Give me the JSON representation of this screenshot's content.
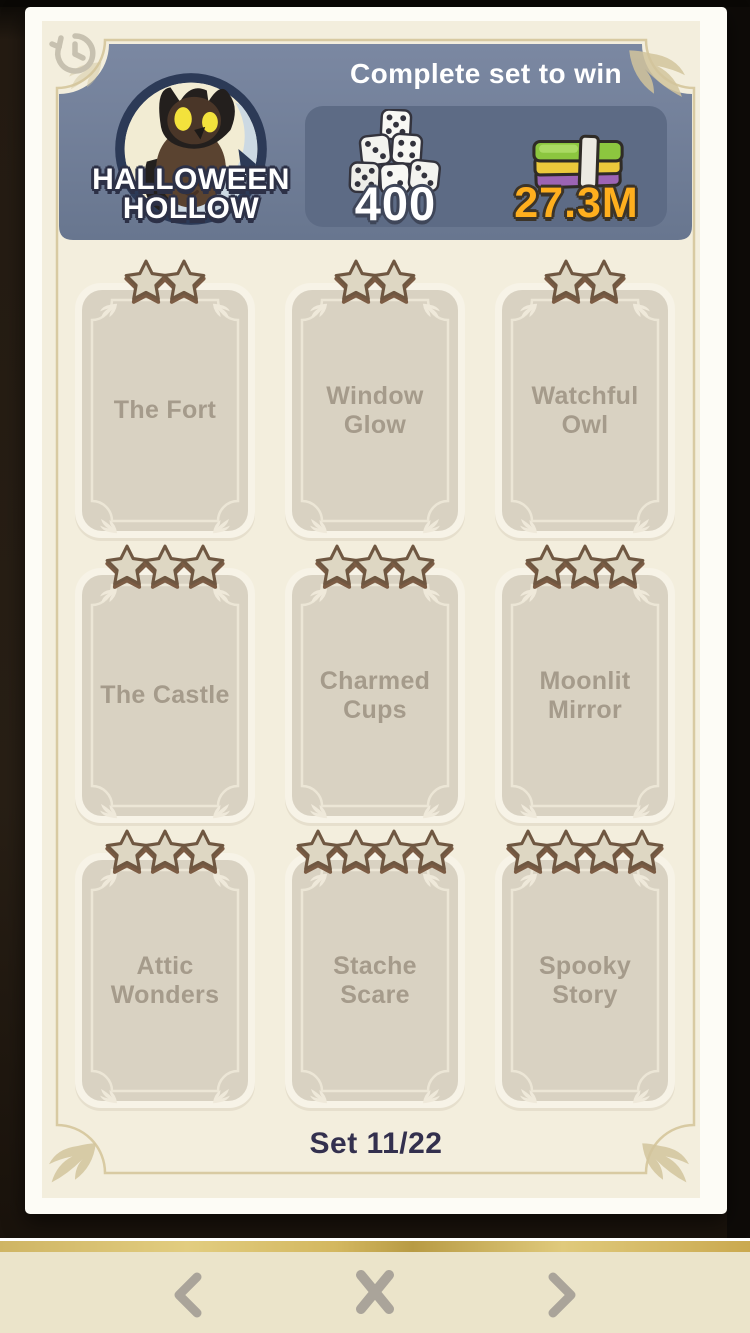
{
  "colors": {
    "page_background": "#f3eedd",
    "banner_background": "#6f7d98",
    "rewards_panel_background": "#5d6b85",
    "card_background": "#d9d2c2",
    "dice_value_color": "#ffffff",
    "cash_value_color": "#ffaf1e",
    "frame_line": "#d8caa2",
    "navbar_background": "#ebe4ca",
    "set_label_color": "#33304e"
  },
  "page": {
    "back_icon": "history-icon",
    "banner": {
      "logo_line1": "HALLOWEEN",
      "logo_line2": "HOLLOW",
      "logo_icon": "owl-moon-badge",
      "subtitle": "Complete set to win",
      "rewards": {
        "dice": {
          "icon": "dice-stack-icon",
          "value": "400"
        },
        "cash": {
          "icon": "cash-stack-icon",
          "value": "27.3M"
        }
      }
    },
    "cards": [
      {
        "name": "The Fort",
        "stars": 2
      },
      {
        "name": "Window Glow",
        "stars": 2
      },
      {
        "name": "Watchful Owl",
        "stars": 2
      },
      {
        "name": "The Castle",
        "stars": 3
      },
      {
        "name": "Charmed Cups",
        "stars": 3
      },
      {
        "name": "Moonlit Mirror",
        "stars": 3
      },
      {
        "name": "Attic Wonders",
        "stars": 3
      },
      {
        "name": "Stache Scare",
        "stars": 4
      },
      {
        "name": "Spooky Story",
        "stars": 4
      }
    ],
    "set_label": "Set 11/22"
  },
  "navbar": {
    "prev_icon": "chevron-left-icon",
    "close_icon": "x-icon",
    "next_icon": "chevron-right-icon"
  }
}
